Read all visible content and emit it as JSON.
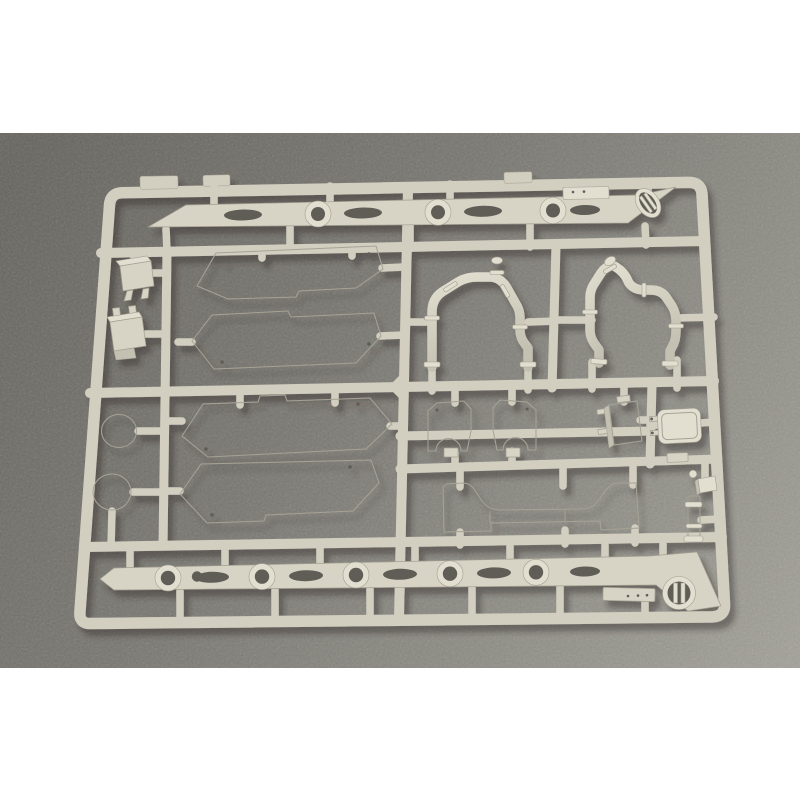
{
  "scene": {
    "description": "Photograph of a beige injection-molded plastic sprue (model kit parts tree) lying on a mottled dark-gray surface, framed by white letterbox bands at the top and bottom of the image",
    "subject": "model-kit sprue with armor-vehicle parts",
    "letterbox_color": "#ffffff"
  },
  "palette": {
    "bg-a": "#67655f",
    "bg-b": "#787670",
    "bg-c": "#8b8a83",
    "bg-d": "#9e9d95",
    "sprue-base": "#d2cec0",
    "sprue-dark": "#a29e90",
    "part-face": "#d7d3c5",
    "part-light": "#e2dfd1",
    "part-shade": "#c4c0b2",
    "hole": "#5f5d56",
    "line": "#a6a295",
    "shadow": "#2a2823"
  },
  "parts": [
    {
      "name": "top-fender-strip",
      "desc": "long strip with oval slots, round bosses and a tilted oval hatch at its angled right end"
    },
    {
      "name": "bottom-fender-strip",
      "desc": "long strip with round bosses, oval slots and a slotted circular hatch on its angled right end"
    },
    {
      "name": "side-panel-1",
      "desc": "large flat skirt panel, upper left"
    },
    {
      "name": "side-panel-2",
      "desc": "large flat skirt panel, second from top"
    },
    {
      "name": "side-panel-3",
      "desc": "large flat skirt panel with pointed right end"
    },
    {
      "name": "side-panel-4",
      "desc": "large flat skirt panel, lower left"
    },
    {
      "name": "pipe-arch-left",
      "desc": "arched pipe part with capped stub and collar rings"
    },
    {
      "name": "pipe-arch-right",
      "desc": "arched pipe part with angled capped stub and collar rings"
    },
    {
      "name": "bracket-upper-left",
      "desc": "small box bracket with two legs"
    },
    {
      "name": "bracket-lower-left",
      "desc": "small stepped box bracket"
    },
    {
      "name": "disc-upper",
      "desc": "small round disc"
    },
    {
      "name": "disc-lower",
      "desc": "small round disc"
    },
    {
      "name": "axle-mount-left",
      "desc": "small bracket with semicircular notch"
    },
    {
      "name": "axle-mount-right",
      "desc": "mirrored small bracket with semicircular notch"
    },
    {
      "name": "equipment-box",
      "desc": "tall rectangular box with side pegs"
    },
    {
      "name": "hatch-plate",
      "desc": "rounded rectangular plate with two pins"
    },
    {
      "name": "suspension-beam",
      "desc": "long beam with raised ends and curved cutouts"
    },
    {
      "name": "periscope-post",
      "desc": "small ribbed cylinder with knob on top"
    },
    {
      "name": "stowage-box",
      "desc": "small flat box attached below the bottom strip"
    }
  ]
}
